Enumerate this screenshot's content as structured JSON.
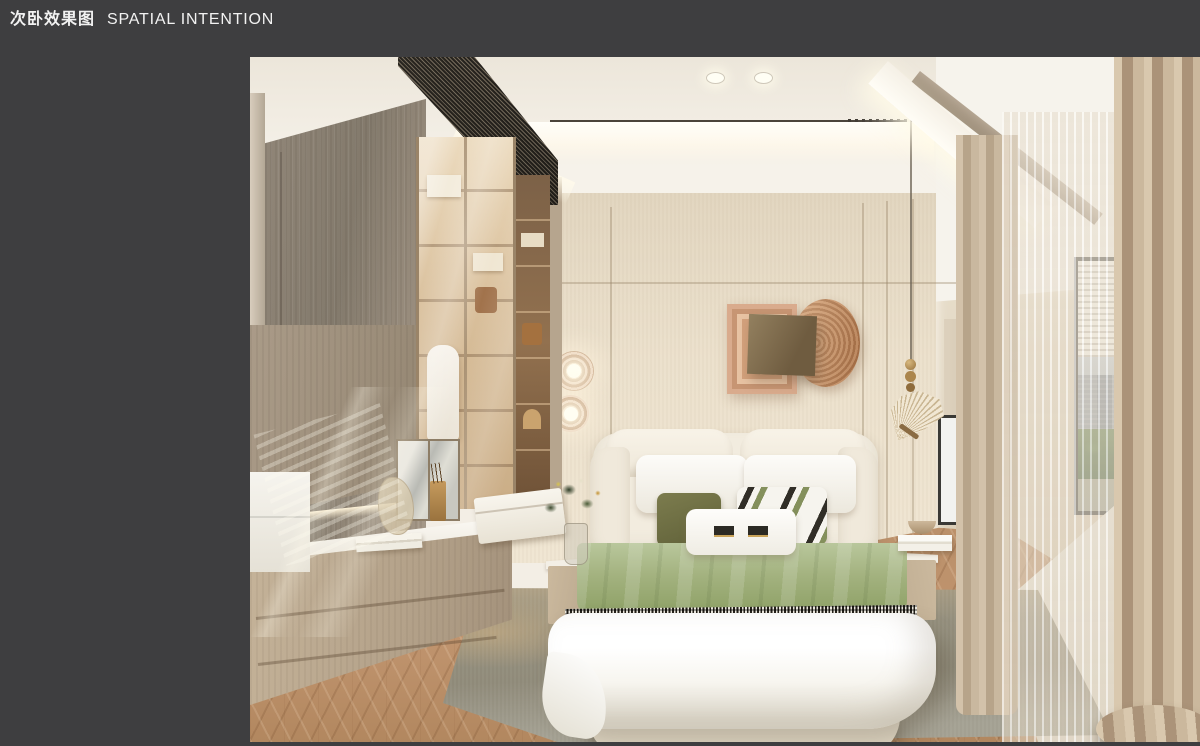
{
  "slide": {
    "title_zh": "次卧效果图",
    "title_en": "SPATIAL INTENTION"
  },
  "palette": {
    "canvas": "#3e3e40",
    "text": "#f2f2f2",
    "ceiling": "#f3eee5",
    "wall": "#e9ddc8",
    "wood": "#94897b",
    "wardrobe": "#d8bd97",
    "grille": "#453f35",
    "blanket": "#a3b27f",
    "duvet": "#f7f5ef",
    "rug": "#8f8a79",
    "floor": "#c0946e",
    "curtain": "#c3ae93",
    "copper": "#d9ab8d"
  }
}
